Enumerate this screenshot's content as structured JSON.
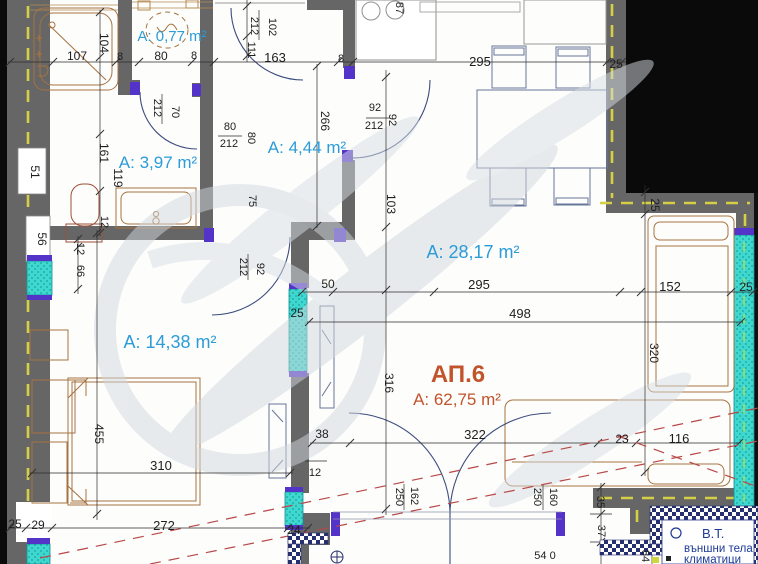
{
  "apartment": {
    "name": "АП.6",
    "area_label": "А: 62,75 m²"
  },
  "room_labels": [
    {
      "text": "А: 0,77 m²",
      "x": 172,
      "y": 41,
      "size": 15,
      "color": "blue"
    },
    {
      "text": "А: 3,97 m²",
      "x": 158,
      "y": 168,
      "size": 17,
      "color": "blue"
    },
    {
      "text": "А: 4,44 m²",
      "x": 307,
      "y": 153,
      "size": 17,
      "color": "blue"
    },
    {
      "text": "А: 28,17 m²",
      "x": 473,
      "y": 258,
      "size": 18,
      "color": "blue"
    },
    {
      "text": "А: 14,38 m²",
      "x": 170,
      "y": 348,
      "size": 18,
      "color": "blue"
    },
    {
      "text": "АП.6",
      "x": 458,
      "y": 382,
      "size": 24,
      "color": "red"
    },
    {
      "text": "А: 62,75 m²",
      "x": 457,
      "y": 405,
      "size": 17,
      "color": "red2"
    }
  ],
  "dimension_labels": [
    {
      "text": "107",
      "x": 77,
      "y": 60,
      "rot": 0,
      "size": 12
    },
    {
      "text": "8",
      "x": 120,
      "y": 60,
      "rot": 0,
      "size": 11
    },
    {
      "text": "80",
      "x": 161,
      "y": 60,
      "rot": 0,
      "size": 12
    },
    {
      "text": "8",
      "x": 194,
      "y": 59,
      "rot": 0,
      "size": 11
    },
    {
      "text": "163",
      "x": 275,
      "y": 62,
      "rot": 0,
      "size": 13
    },
    {
      "text": "8",
      "x": 341,
      "y": 62,
      "rot": 0,
      "size": 11
    },
    {
      "text": "295",
      "x": 480,
      "y": 66,
      "rot": 0,
      "size": 13
    },
    {
      "text": "25",
      "x": 616,
      "y": 68,
      "rot": 0,
      "size": 12
    },
    {
      "text": "104",
      "x": 100,
      "y": 43,
      "rot": 90,
      "size": 12
    },
    {
      "text": "161",
      "x": 100,
      "y": 153,
      "rot": 90,
      "size": 12
    },
    {
      "text": "119",
      "x": 114,
      "y": 178,
      "rot": 90,
      "size": 12
    },
    {
      "text": "51",
      "x": 31,
      "y": 172,
      "rot": 90,
      "size": 12
    },
    {
      "text": "56",
      "x": 38,
      "y": 239,
      "rot": 90,
      "size": 12
    },
    {
      "text": "102",
      "x": 269,
      "y": 27,
      "rot": 90,
      "size": 11
    },
    {
      "text": "212",
      "x": 251,
      "y": 26,
      "rot": 90,
      "size": 11
    },
    {
      "text": "111",
      "x": 248,
      "y": 50,
      "rot": 90,
      "size": 11
    },
    {
      "text": "212",
      "x": 154,
      "y": 108,
      "rot": 90,
      "size": 11
    },
    {
      "text": "70",
      "x": 172,
      "y": 112,
      "rot": 90,
      "size": 11
    },
    {
      "text": "80",
      "x": 230,
      "y": 130,
      "rot": 0,
      "size": 11
    },
    {
      "text": "212",
      "x": 229,
      "y": 147,
      "rot": 0,
      "size": 11
    },
    {
      "text": "80",
      "x": 248,
      "y": 138,
      "rot": 90,
      "size": 11
    },
    {
      "text": "92",
      "x": 375,
      "y": 111,
      "rot": 0,
      "size": 11
    },
    {
      "text": "212",
      "x": 374,
      "y": 129,
      "rot": 0,
      "size": 11
    },
    {
      "text": "92",
      "x": 389,
      "y": 120,
      "rot": 90,
      "size": 11
    },
    {
      "text": "266",
      "x": 321,
      "y": 121,
      "rot": 90,
      "size": 12
    },
    {
      "text": "87",
      "x": 396,
      "y": 8,
      "rot": 90,
      "size": 11
    },
    {
      "text": "103",
      "x": 387,
      "y": 204,
      "rot": 90,
      "size": 12
    },
    {
      "text": "75",
      "x": 249,
      "y": 201,
      "rot": 90,
      "size": 11
    },
    {
      "text": "12",
      "x": 101,
      "y": 222,
      "rot": 90,
      "size": 11
    },
    {
      "text": "12",
      "x": 77,
      "y": 249,
      "rot": 90,
      "size": 11
    },
    {
      "text": "66",
      "x": 77,
      "y": 271,
      "rot": 90,
      "size": 11
    },
    {
      "text": "92",
      "x": 257,
      "y": 269,
      "rot": 90,
      "size": 11
    },
    {
      "text": "212",
      "x": 240,
      "y": 267,
      "rot": 90,
      "size": 11
    },
    {
      "text": "50",
      "x": 328,
      "y": 288,
      "rot": 0,
      "size": 12
    },
    {
      "text": "25",
      "x": 297,
      "y": 317,
      "rot": 0,
      "size": 12
    },
    {
      "text": "295",
      "x": 479,
      "y": 289,
      "rot": 0,
      "size": 13
    },
    {
      "text": "498",
      "x": 520,
      "y": 318,
      "rot": 0,
      "size": 13
    },
    {
      "text": "152",
      "x": 670,
      "y": 291,
      "rot": 0,
      "size": 13
    },
    {
      "text": "25",
      "x": 746,
      "y": 291,
      "rot": 0,
      "size": 12
    },
    {
      "text": "25",
      "x": 651,
      "y": 205,
      "rot": 90,
      "size": 12
    },
    {
      "text": "320",
      "x": 650,
      "y": 353,
      "rot": 90,
      "size": 12
    },
    {
      "text": "316",
      "x": 385,
      "y": 383,
      "rot": 90,
      "size": 12
    },
    {
      "text": "455",
      "x": 95,
      "y": 434,
      "rot": 90,
      "size": 12
    },
    {
      "text": "310",
      "x": 161,
      "y": 470,
      "rot": 0,
      "size": 13
    },
    {
      "text": "38",
      "x": 322,
      "y": 438,
      "rot": 0,
      "size": 12
    },
    {
      "text": "322",
      "x": 475,
      "y": 439,
      "rot": 0,
      "size": 13
    },
    {
      "text": "23",
      "x": 622,
      "y": 443,
      "rot": 0,
      "size": 12
    },
    {
      "text": "116",
      "x": 679,
      "y": 443,
      "rot": 0,
      "size": 13
    },
    {
      "text": "12",
      "x": 315,
      "y": 476,
      "rot": 0,
      "size": 11
    },
    {
      "text": "162",
      "x": 411,
      "y": 496,
      "rot": 90,
      "size": 11
    },
    {
      "text": "250",
      "x": 396,
      "y": 497,
      "rot": 90,
      "size": 11
    },
    {
      "text": "160",
      "x": 550,
      "y": 497,
      "rot": 90,
      "size": 11
    },
    {
      "text": "250",
      "x": 534,
      "y": 497,
      "rot": 90,
      "size": 11
    },
    {
      "text": "35",
      "x": 597,
      "y": 502,
      "rot": 90,
      "size": 11
    },
    {
      "text": "37",
      "x": 598,
      "y": 531,
      "rot": 90,
      "size": 11
    },
    {
      "text": "84",
      "x": 642,
      "y": 556,
      "rot": 90,
      "size": 11
    },
    {
      "text": "25",
      "x": 15,
      "y": 528,
      "rot": 0,
      "size": 12
    },
    {
      "text": "29",
      "x": 38,
      "y": 529,
      "rot": 0,
      "size": 12
    },
    {
      "text": "272",
      "x": 164,
      "y": 530,
      "rot": 0,
      "size": 13
    },
    {
      "text": "24",
      "x": 294,
      "y": 534,
      "rot": 0,
      "size": 12
    },
    {
      "text": "54 0",
      "x": 545,
      "y": 559,
      "rot": 0,
      "size": 11
    }
  ],
  "legend": {
    "title": "В.Т.",
    "line1": "външни тела",
    "line2": "климатици"
  },
  "colors": {
    "wall": "#666666",
    "window_cyan": "#3fd8d0",
    "jamb_purple": "#5433c8",
    "dash_yellow": "#d4cf45",
    "label_blue": "#2b9cd8",
    "label_red": "#c2542b",
    "navy": "#1d3a96",
    "red_dash": "#b84848",
    "furniture_tan": "#a5723f"
  }
}
